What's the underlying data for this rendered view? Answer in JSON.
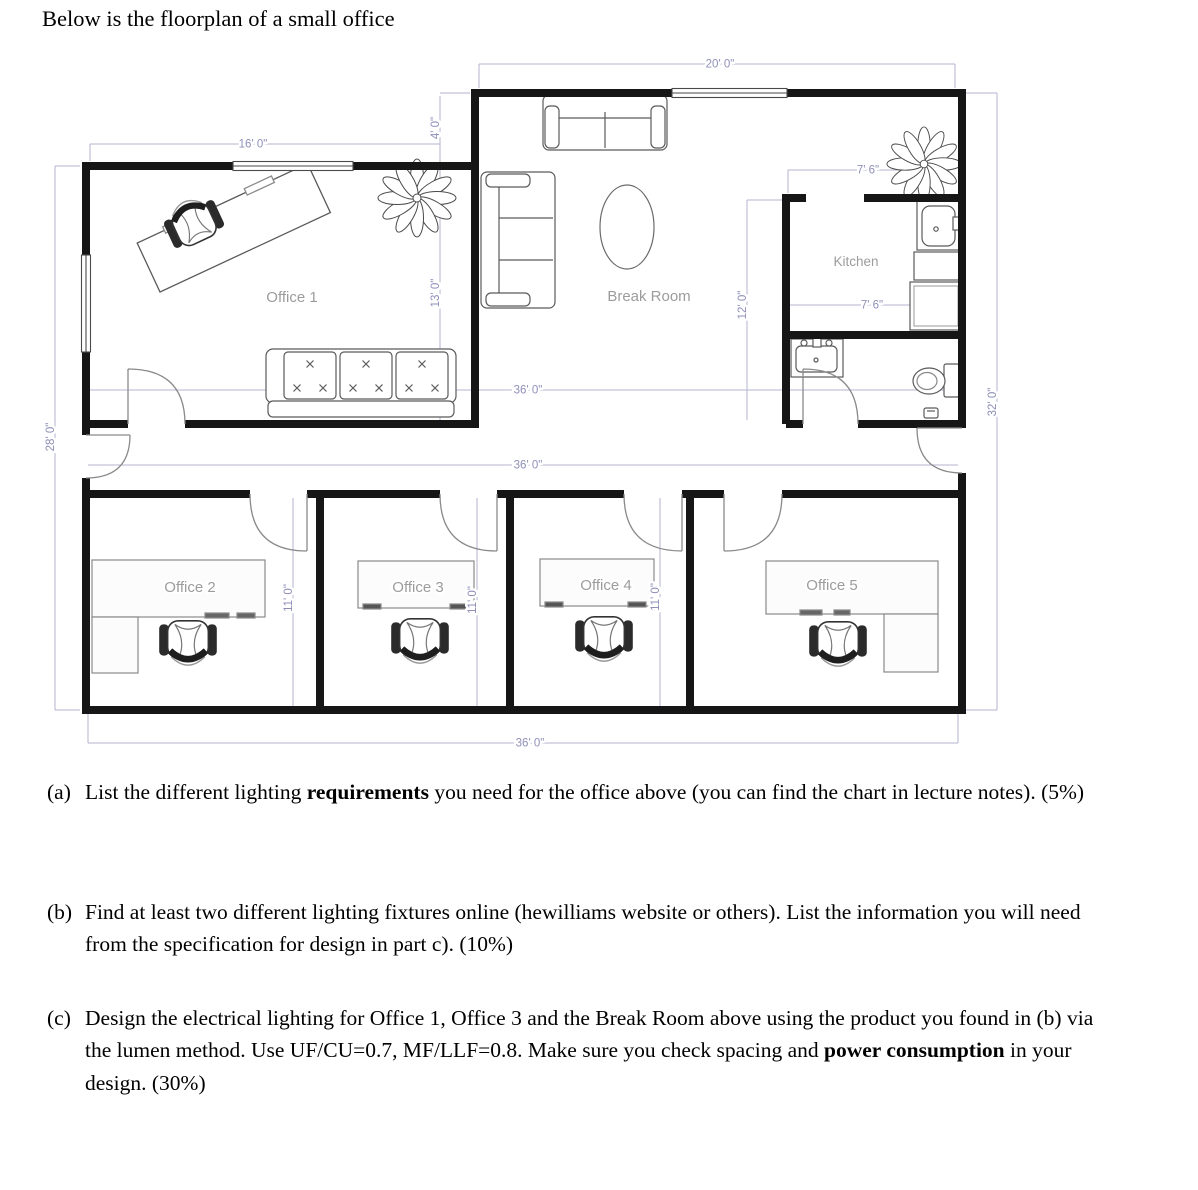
{
  "page": {
    "title": "Below is the floorplan of a small office"
  },
  "floorplan": {
    "rooms": {
      "office1": "Office 1",
      "break_room": "Break Room",
      "kitchen": "Kitchen",
      "office2": "Office 2",
      "office3": "Office 3",
      "office4": "Office 4",
      "office5": "Office 5"
    },
    "dims": {
      "top_width": "20' 0\"",
      "office1_width": "16' 0\"",
      "entry_recess": "4' 0\"",
      "office1_depth": "13' 0\"",
      "kitchen_width_top": "7' 6\"",
      "kitchen_width_bottom": "7' 6\"",
      "kitchen_depth": "12' 0\"",
      "left_height": "28' 0\"",
      "right_height": "32' 0\"",
      "upper_width": "36' 0\"",
      "corridor_width": "36' 0\"",
      "bottom_width": "36' 0\"",
      "office2_depth": "11' 0\"",
      "office3_depth": "11' 0\"",
      "office4_depth": "11' 0\""
    },
    "colors": {
      "wall": "#161616",
      "dimension": "#8f8fb8",
      "room_label": "#9c9c9c"
    }
  },
  "questions": [
    {
      "tag": "(a)",
      "parts": [
        {
          "text": "List the different lighting "
        },
        {
          "text": "requirements",
          "bold": true
        },
        {
          "text": " you need for the office above (you can find the chart in lecture notes). (5%)"
        }
      ]
    },
    {
      "tag": "(b)",
      "parts": [
        {
          "text": "Find at least two different lighting fixtures online (hewilliams website or others). List the information you will need from the specification for design in part c). (10%)"
        }
      ]
    },
    {
      "tag": "(c)",
      "parts": [
        {
          "text": "Design the electrical lighting for Office 1, Office 3 and the Break Room above using the product you found in (b) via the lumen method. Use UF/CU=0.7, MF/LLF=0.8. Make sure you check spacing and "
        },
        {
          "text": "power consumption",
          "bold": true
        },
        {
          "text": " in your design. (30%)"
        }
      ]
    }
  ]
}
